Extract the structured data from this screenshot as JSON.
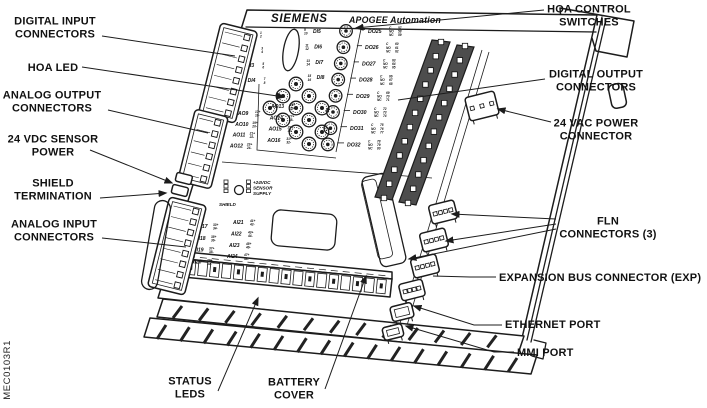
{
  "figure_code": "MEC0103R1",
  "nameplate": {
    "brand": "SIEMENS",
    "product": "APOGEE Automation"
  },
  "callouts": {
    "digital_input": [
      "DIGITAL INPUT",
      "CONNECTORS"
    ],
    "hoa_led": [
      "HOA LED"
    ],
    "analog_output": [
      "ANALOG OUTPUT",
      "CONNECTORS"
    ],
    "sensor_power": [
      "24 VDC SENSOR",
      "POWER"
    ],
    "shield_termination": [
      "SHIELD",
      "TERMINATION"
    ],
    "analog_input": [
      "ANALOG INPUT",
      "CONNECTORS"
    ],
    "status_leds": [
      "STATUS",
      "LEDS"
    ],
    "battery_cover": [
      "BATTERY",
      "COVER"
    ],
    "hoa_switches": [
      "HOA CONTROL",
      "SWITCHES"
    ],
    "digital_output": [
      "DIGITAL OUTPUT",
      "CONNECTORS"
    ],
    "vac_power": [
      "24 VAC POWER",
      "CONNECTOR"
    ],
    "fln": [
      "FLN",
      "CONNECTORS (3)"
    ],
    "expansion": [
      "EXPANSION BUS CONNECTOR (EXP)"
    ],
    "ethernet": [
      "ETHERNET PORT"
    ],
    "mmi": [
      "MMI PORT"
    ]
  },
  "board": {
    "di_left": [
      {
        "label": "DI1",
        "terms": [
          "1",
          "2"
        ]
      },
      {
        "label": "DI2",
        "terms": [
          "3",
          "4"
        ]
      },
      {
        "label": "DI3",
        "terms": [
          "5",
          "6"
        ]
      },
      {
        "label": "DI4",
        "terms": [
          "7",
          "8"
        ]
      }
    ],
    "di_right": [
      {
        "label": "DI5",
        "terms": [
          "9",
          "10"
        ]
      },
      {
        "label": "DI6",
        "terms": [
          "11",
          "12"
        ]
      },
      {
        "label": "DI7",
        "terms": [
          "13",
          "14"
        ]
      },
      {
        "label": "DI8",
        "terms": [
          "15",
          "16"
        ]
      }
    ],
    "do_rows": [
      {
        "label": "DO25",
        "contacts": [
          "C",
          "NO",
          "NC"
        ],
        "terms": [
          "57",
          "58",
          "59"
        ]
      },
      {
        "label": "DO26",
        "contacts": [
          "C",
          "NO",
          "NC"
        ],
        "terms": [
          "60",
          "61",
          "62"
        ]
      },
      {
        "label": "DO27",
        "contacts": [
          "C",
          "NO",
          "NC"
        ],
        "terms": [
          "63",
          "64",
          "65"
        ]
      },
      {
        "label": "DO28",
        "contacts": [
          "C",
          "NO",
          "NC"
        ],
        "terms": [
          "66",
          "67",
          "68"
        ]
      },
      {
        "label": "DO29",
        "contacts": [
          "C",
          "NO",
          "NC"
        ],
        "terms": [
          "69",
          "70",
          "71"
        ]
      },
      {
        "label": "DO30",
        "contacts": [
          "C",
          "NO",
          "NC"
        ],
        "terms": [
          "72",
          "73",
          "74"
        ]
      },
      {
        "label": "DO31",
        "contacts": [
          "C",
          "NO",
          "NC"
        ],
        "terms": [
          "75",
          "76",
          "77"
        ]
      },
      {
        "label": "DO32",
        "contacts": [
          "C",
          "NO",
          "NC"
        ],
        "terms": [
          "78",
          "79",
          "80"
        ]
      }
    ],
    "ao_left": [
      {
        "label": "AO9",
        "terms": [
          "17+",
          "18-"
        ]
      },
      {
        "label": "AO10",
        "terms": [
          "19+",
          "20-"
        ]
      },
      {
        "label": "AO11",
        "terms": [
          "21+",
          "22-"
        ]
      },
      {
        "label": "AO12",
        "terms": [
          "23+",
          "24-"
        ]
      }
    ],
    "ao_right": [
      {
        "label": "AO13",
        "terms": [
          "25+",
          "26-"
        ]
      },
      {
        "label": "AO14",
        "terms": [
          "27+",
          "28-"
        ]
      },
      {
        "label": "AO15",
        "terms": [
          "29+",
          "30-"
        ]
      },
      {
        "label": "AO16",
        "terms": [
          "31+",
          "32-"
        ]
      }
    ],
    "ai_left": [
      {
        "label": "AI17",
        "terms": [
          "33+",
          "34-"
        ]
      },
      {
        "label": "AI18",
        "terms": [
          "35+",
          "36-"
        ]
      },
      {
        "label": "AI19",
        "terms": [
          "37+",
          "38-"
        ]
      },
      {
        "label": "AI20",
        "terms": [
          "39+",
          "40-"
        ]
      }
    ],
    "ai_right": [
      {
        "label": "AI21",
        "terms": [
          "41+",
          "42-"
        ]
      },
      {
        "label": "AI22",
        "terms": [
          "43+",
          "44-"
        ]
      },
      {
        "label": "AI23",
        "terms": [
          "45+",
          "46-"
        ]
      },
      {
        "label": "AI24",
        "terms": [
          "47+",
          "48-"
        ]
      }
    ],
    "sensor_supply": [
      "+24VDC",
      "SENSOR",
      "SUPPLY"
    ],
    "shield_label": "SHIELD"
  },
  "colors": {
    "ink": "#1c1c1c",
    "paper": "#ffffff",
    "connector_dark": "#4d4d4d"
  }
}
